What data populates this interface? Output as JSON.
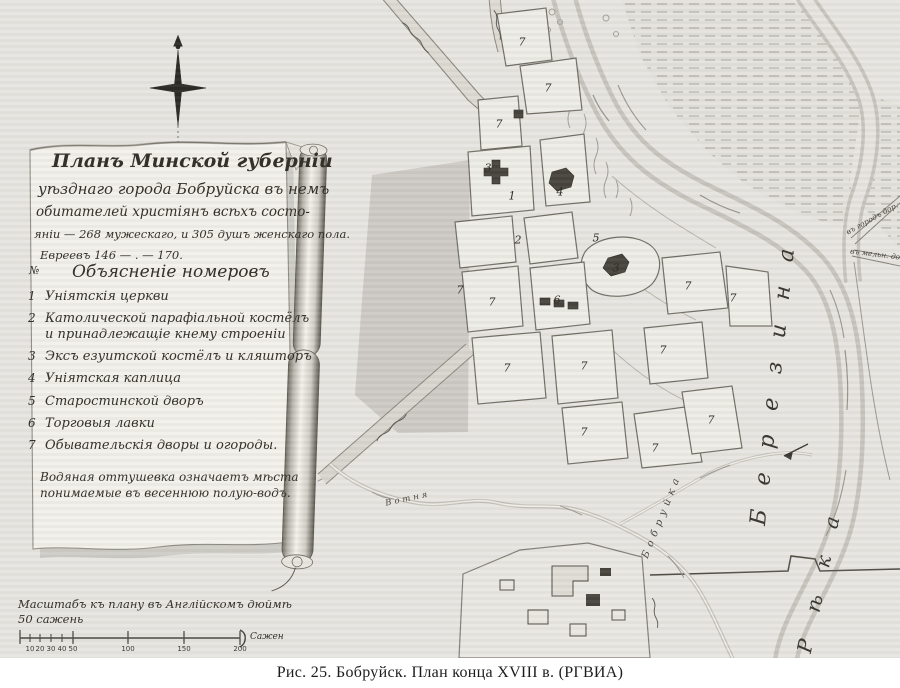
{
  "figure": {
    "caption": "Рис. 25. Бобруйск. План конца XVIII в. (РГВИА)"
  },
  "colors": {
    "paper": "#e7e5e0",
    "ink": "#33312a",
    "dark_building": "#45433b",
    "bank": "#c6c4bd"
  },
  "cartouche": {
    "title_lines": [
      "Планъ Минской губерніи",
      "уѣзднаго города Бобруйска въ немъ",
      "обитателей христіянъ всѣхъ состо-",
      "яніи — 268 мужескаго, и 305 душъ женскаго пола.",
      "Евреевъ 146 — . — 170."
    ],
    "legend": {
      "header_no": "№",
      "header": "Объясненіе номеровъ",
      "items": [
        {
          "num": "1",
          "text": "Уніятскія церкви"
        },
        {
          "num": "2",
          "text": "Католической парафіальной костёлъ",
          "text2": "и принадлежащіе кнему строеніи"
        },
        {
          "num": "3",
          "text": "Эксъ езуитской костёлъ и кляшторъ"
        },
        {
          "num": "4",
          "text": "Уніятская каплица"
        },
        {
          "num": "5",
          "text": "Старостинской дворъ"
        },
        {
          "num": "6",
          "text": "Торговыя лавки"
        },
        {
          "num": "7",
          "text": "Обывательскія дворы и огороды."
        }
      ],
      "note_lines": [
        "Водяная оттушевка означаетъ мѣста",
        "понимаемые въ весеннюю полую-водъ."
      ]
    }
  },
  "scale": {
    "title_line1": "Масштабъ къ плану въ Англійскомъ дюймѣ",
    "title_line2": "50 сажень",
    "ticks": [
      "10",
      "20",
      "30",
      "40",
      "50",
      "100",
      "150",
      "200"
    ],
    "unit": "Сажен"
  },
  "map": {
    "river_main_label": "Березина",
    "river_word": "Рѣка",
    "stream1_label": "Бобруйка",
    "stream2_label": "Вотня",
    "road_label_1": "въ городъ дор.",
    "road_label_2": "въ мельн. дор.",
    "block_labels": [
      {
        "label": "7",
        "x": 522,
        "y": 42
      },
      {
        "label": "7",
        "x": 548,
        "y": 88
      },
      {
        "label": "7",
        "x": 499,
        "y": 124
      },
      {
        "label": "3",
        "x": 488,
        "y": 168
      },
      {
        "label": "1",
        "x": 512,
        "y": 196
      },
      {
        "label": "4",
        "x": 560,
        "y": 192
      },
      {
        "label": "2",
        "x": 518,
        "y": 240
      },
      {
        "label": "5",
        "x": 596,
        "y": 238
      },
      {
        "label": "3",
        "x": 616,
        "y": 268
      },
      {
        "label": "6",
        "x": 557,
        "y": 300
      },
      {
        "label": "7",
        "x": 460,
        "y": 290
      },
      {
        "label": "7",
        "x": 492,
        "y": 302
      },
      {
        "label": "7",
        "x": 507,
        "y": 368
      },
      {
        "label": "7",
        "x": 584,
        "y": 366
      },
      {
        "label": "7",
        "x": 688,
        "y": 286
      },
      {
        "label": "7",
        "x": 733,
        "y": 298
      },
      {
        "label": "7",
        "x": 663,
        "y": 350
      },
      {
        "label": "7",
        "x": 584,
        "y": 432
      },
      {
        "label": "7",
        "x": 655,
        "y": 448
      },
      {
        "label": "7",
        "x": 711,
        "y": 420
      }
    ]
  }
}
